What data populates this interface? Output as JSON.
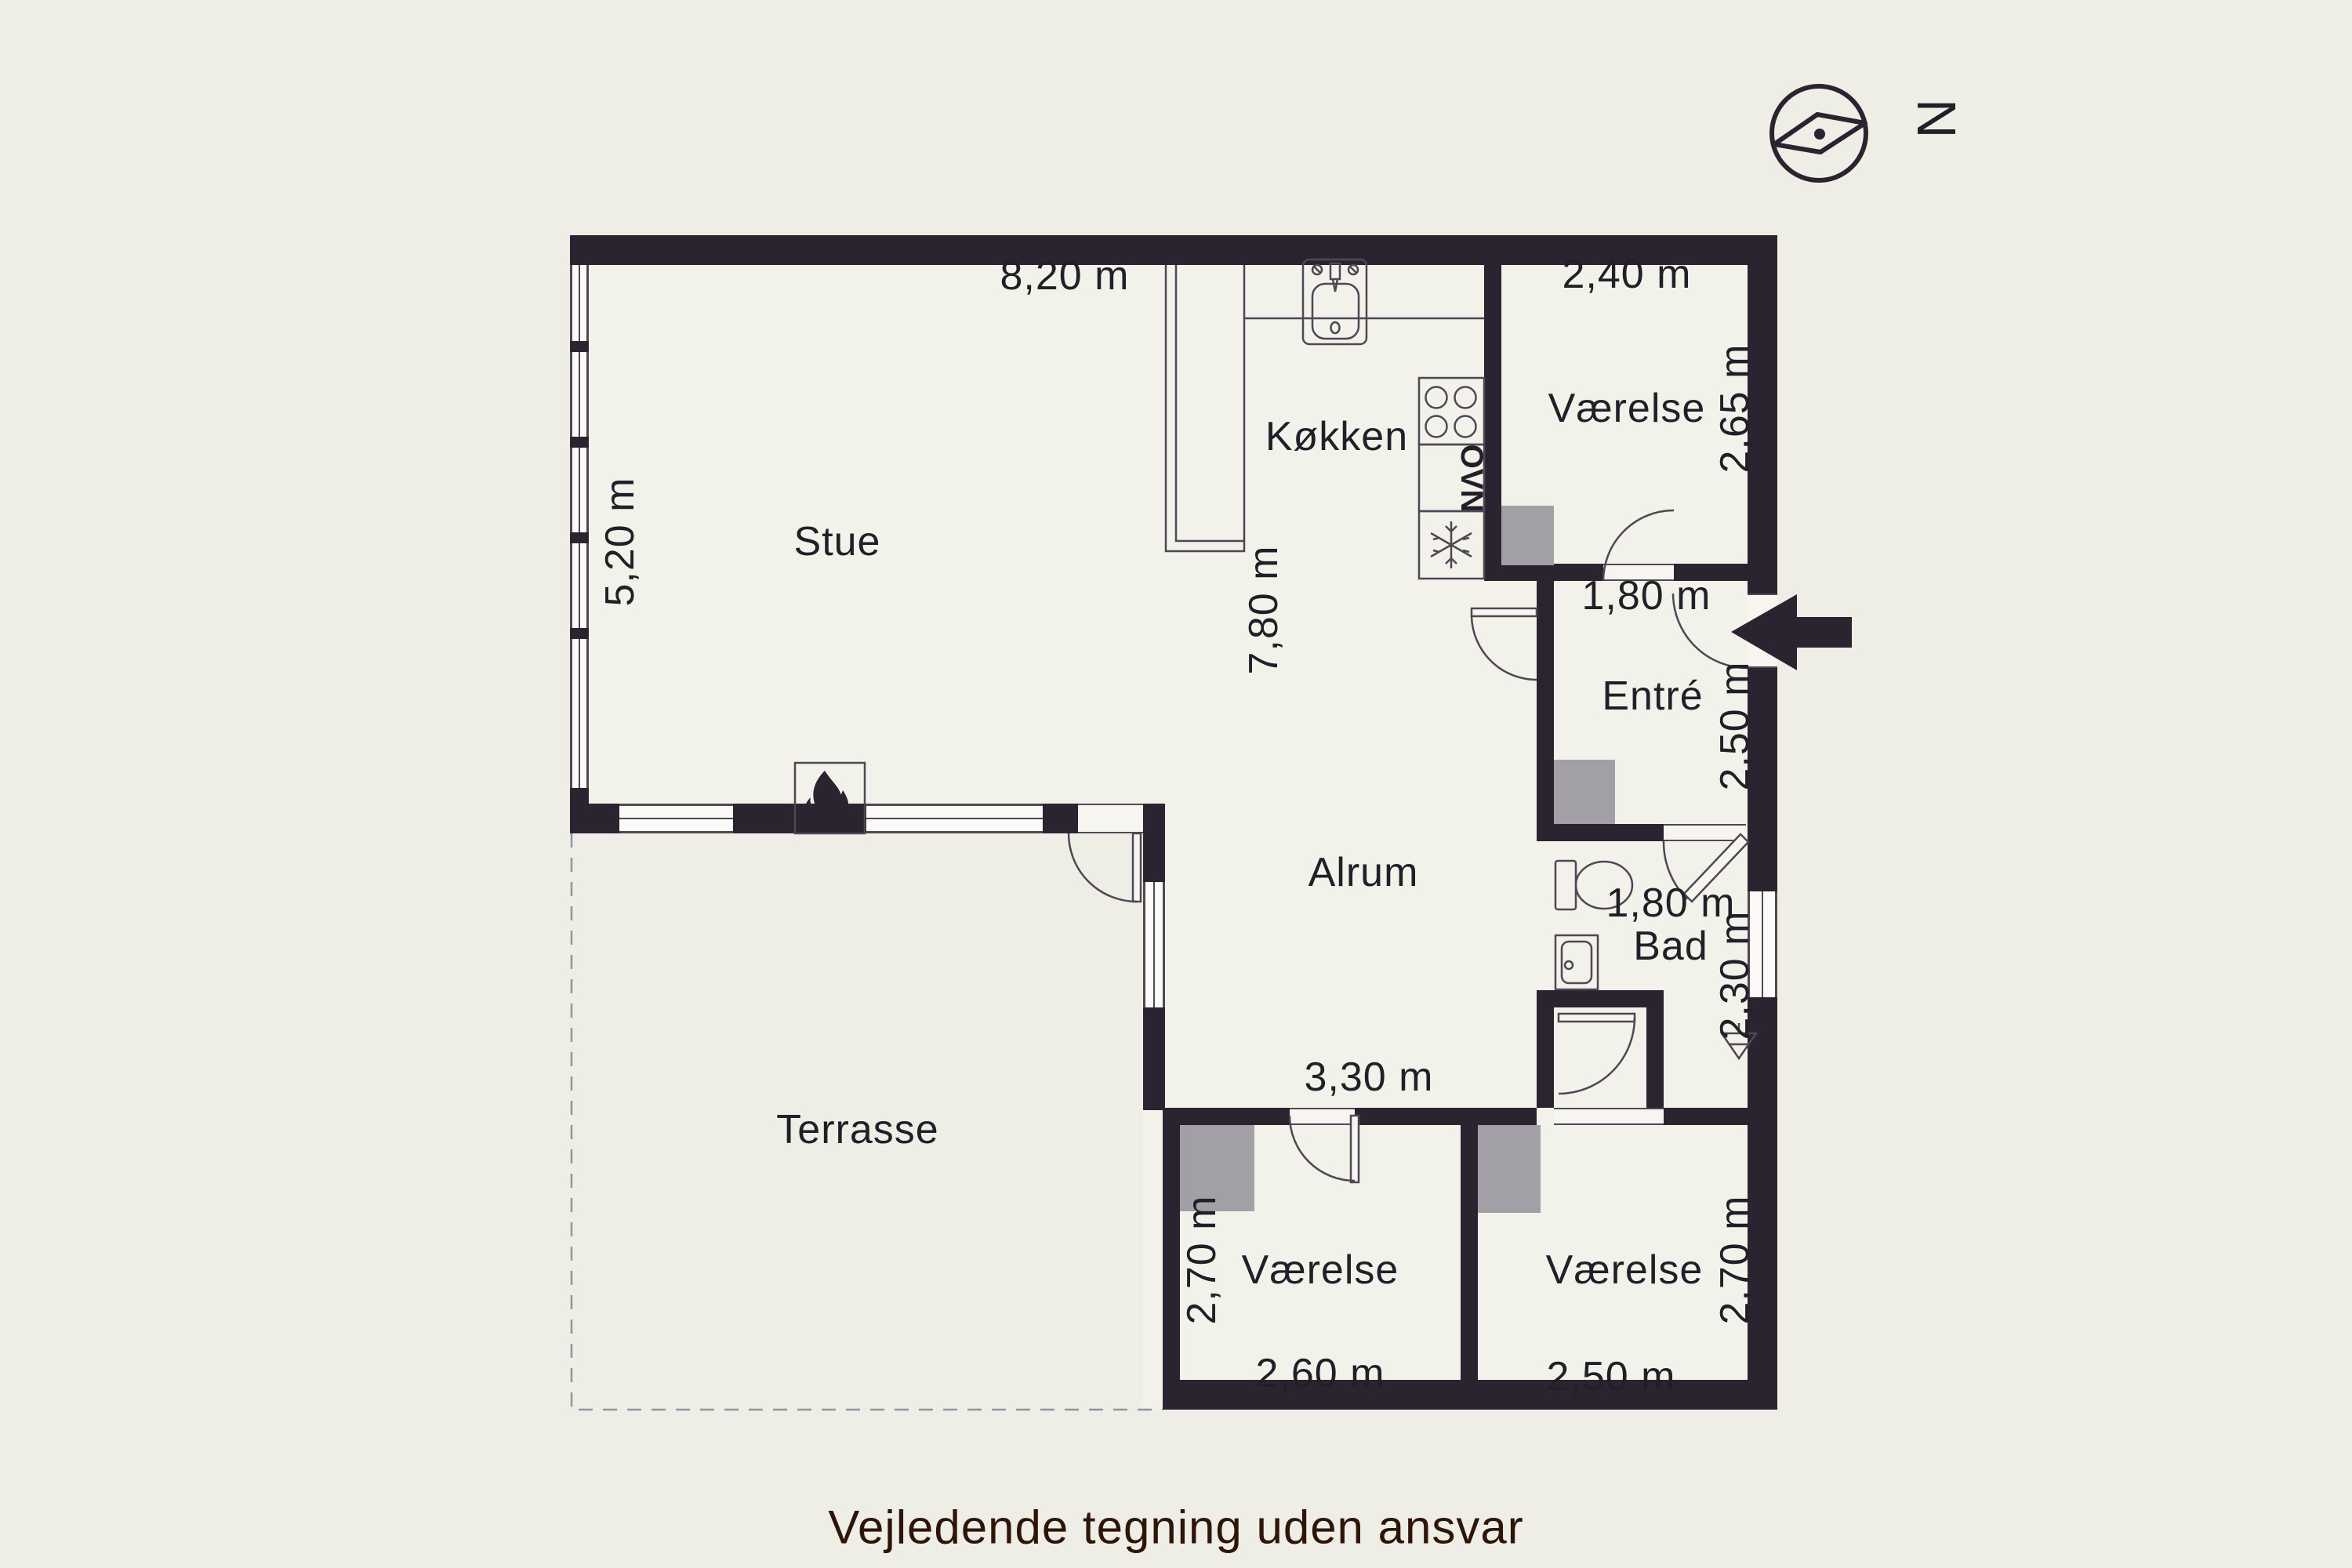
{
  "meta": {
    "disclaimer": "Vejledende tegning uden ansvar",
    "compass_letter": "N"
  },
  "colors": {
    "background": "#eeede6",
    "floor": "#f2f1ea",
    "wall": "#29242f",
    "closet": "#a39fa6",
    "fixture_line": "#4d4853",
    "disclaimer_text": "#2e1507"
  },
  "icons": {
    "compass": "compass-icon",
    "entry_arrow": "entry-arrow-icon",
    "fireplace": "fire-icon",
    "freezer": "snowflake-icon",
    "stove": "burners-icon",
    "sink": "sink-icon",
    "toilet": "toilet-icon",
    "washbasin": "washbasin-icon",
    "drain": "floor-drain-icon"
  },
  "appliances": {
    "oven_label": "OVN"
  },
  "rooms": {
    "stue": {
      "name": "Stue",
      "width": "8,20 m",
      "height": "5,20 m"
    },
    "kokken": {
      "name": "Køkken",
      "depth": "7,80 m"
    },
    "vaerelse_ne": {
      "name": "Værelse",
      "width": "2,40 m",
      "height": "2,65 m"
    },
    "hall": {
      "width": "1,80 m"
    },
    "entre": {
      "name": "Entré",
      "height": "2,50 m"
    },
    "alrum": {
      "name": "Alrum",
      "width": "3,30 m"
    },
    "bad": {
      "name": "Bad",
      "width": "1,80 m",
      "height": "2,30 m"
    },
    "terrasse": {
      "name": "Terrasse"
    },
    "vaerelse_sw": {
      "name": "Værelse",
      "width": "2,60 m",
      "height": "2,70 m"
    },
    "vaerelse_se": {
      "name": "Værelse",
      "width": "2,50 m",
      "height": "2,70 m"
    }
  }
}
